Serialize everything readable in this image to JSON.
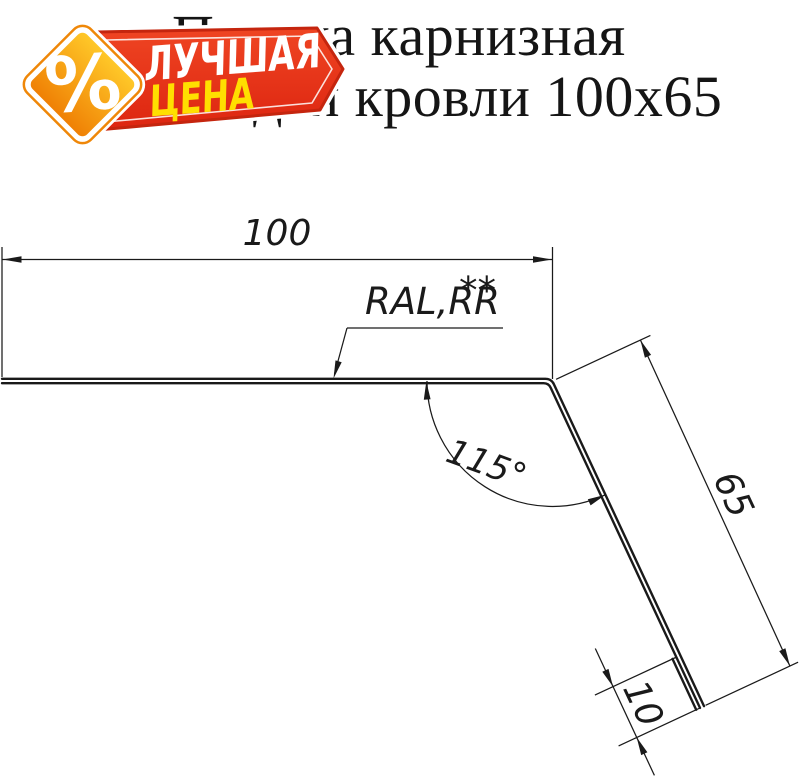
{
  "title": {
    "line1": "Планка карнизная",
    "line2": "для кровли 100x65"
  },
  "badge": {
    "percent": "%",
    "line1": "ЛУЧШАЯ",
    "line2": "ЦЕНА",
    "banner_red": "#e33019",
    "diamond_orange": "#f79a0e",
    "text_yellow": "#ffdf00",
    "text_white": "#ffffff"
  },
  "drawing": {
    "dim_width": "100",
    "dim_side": "65",
    "dim_hem": "10",
    "dim_angle": "115°",
    "material_note": "RAL,RR",
    "material_note_stars": "**",
    "line_color": "#1a1a1a"
  }
}
